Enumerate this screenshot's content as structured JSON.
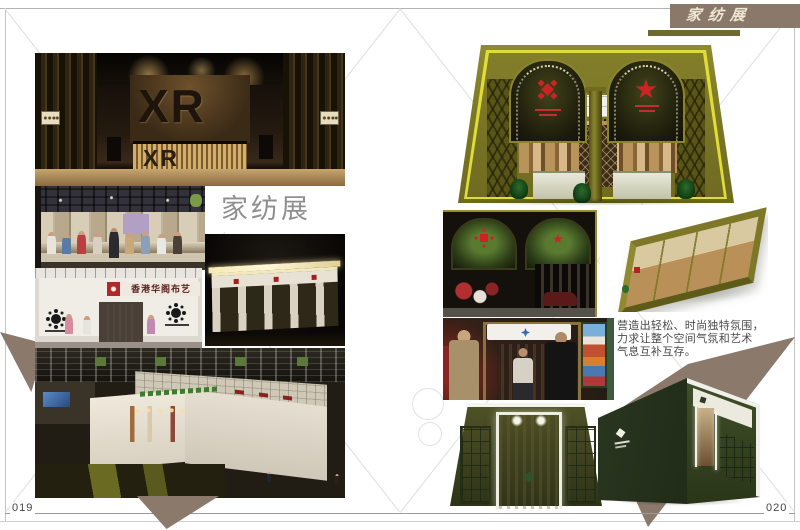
{
  "header": {
    "banner_label": "家纺展"
  },
  "left_page": {
    "folio": "019",
    "section_label": "家纺展",
    "photos": {
      "xr_booth": {
        "wall_text": "XR",
        "desk_text": "XR",
        "alt": "XR 展位室内效果图"
      },
      "crowd": {
        "alt": "展会现场人群照片"
      },
      "hk_booth": {
        "banner_text": "香港华阁布艺",
        "alt": "香港华阁布艺展位照片"
      },
      "night_facade": {
        "alt": "展位外立面夜景效果图"
      },
      "aerial_hall": {
        "alt": "展馆俯瞰实景照片"
      }
    }
  },
  "right_page": {
    "folio": "020",
    "caption_lines": [
      "营造出轻松、时尚独特氛围，",
      "力求让整个空间气氛和艺术",
      "气息互补互存。"
    ],
    "photos": {
      "arch_render": {
        "alt": "双拱门展位正面效果图"
      },
      "interior_photo": {
        "alt": "展位内部实景照片"
      },
      "iso_render": {
        "alt": "展位鸟瞰效果图"
      },
      "entrance_photo": {
        "alt": "展位入口实景照片"
      },
      "green_entrance_render": {
        "alt": "墨绿展位入口效果图"
      },
      "green_exterior_render": {
        "alt": "墨绿展位外观效果图"
      }
    }
  },
  "colors": {
    "taupe": "#8b7a6b",
    "banner_bg": "#8a796b",
    "olive": "#7d7828",
    "trim_yellow": "#e0dc38",
    "dark_green": "#37451f",
    "label_gray": "#8f8f8f"
  }
}
